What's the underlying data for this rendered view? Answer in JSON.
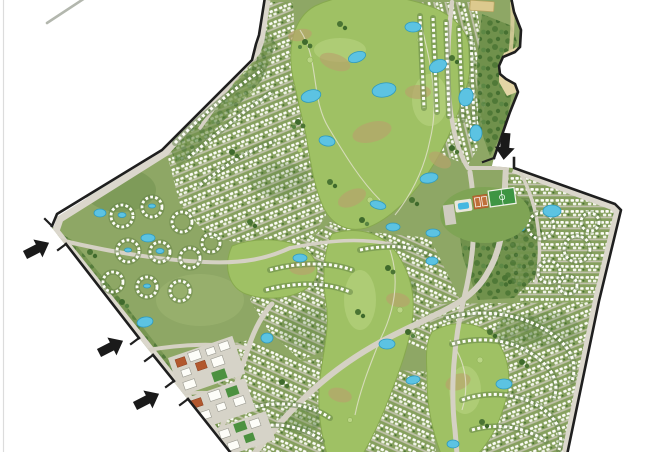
{
  "meta": {
    "title": "Golf community master plan",
    "description": "Aerial master plan rendering of a golf-course residential community with winding housing rows, lakes, a central golf course, sports complex, town center and four gated entrances marked with black arrows.",
    "canvas": {
      "width": 668,
      "height": 452
    }
  },
  "colors": {
    "background": "#ffffff",
    "edge_line": "#dcdcdc",
    "offsite_road": "#b3b7ae",
    "site_green": "#8ea765",
    "pattern_base": "#86a05e",
    "street": "#cbc8ba",
    "house_white": "#fdfdf8",
    "hedge": "#5f7f43",
    "forest_base": "#6e8f4a",
    "tree_dark": "#3f6a2c",
    "tree_mid": "#4a7433",
    "tree_light": "#578441",
    "fairway": "#9fc164",
    "fairway_edge": "#87a94e",
    "fairway_light": "#b9d584",
    "rough": "#b8a36c",
    "lake": "#5cc3e2",
    "lake_edge": "#2e9abf",
    "road": "#d5d1c4",
    "road_band": "#dbd7cc",
    "plaza": "#d6d3c8",
    "roof_orange": "#b2582e",
    "lawn_green": "#4c9140",
    "pitch": "#3e9543",
    "court": "#bf6f39",
    "pool": "#45b7e0",
    "sand": "#e3d5a5",
    "tan_building": "#dcc98e",
    "boundary": "#1f1f1f",
    "arrow": "#1a1a1a"
  },
  "map": {
    "landmarks": [
      "golf-course",
      "lakes",
      "sports-complex",
      "town-center",
      "beach-plaza",
      "housing-clusters"
    ],
    "entrances": [
      {
        "id": "north-entrance",
        "arrow_transform": "translate(506,133) rotate(95)"
      },
      {
        "id": "west-entrance-1",
        "arrow_transform": "translate(25,255) rotate(-27)"
      },
      {
        "id": "west-entrance-2",
        "arrow_transform": "translate(99,353) rotate(-27)"
      },
      {
        "id": "west-entrance-3",
        "arrow_transform": "translate(135,406) rotate(-27)"
      }
    ]
  }
}
